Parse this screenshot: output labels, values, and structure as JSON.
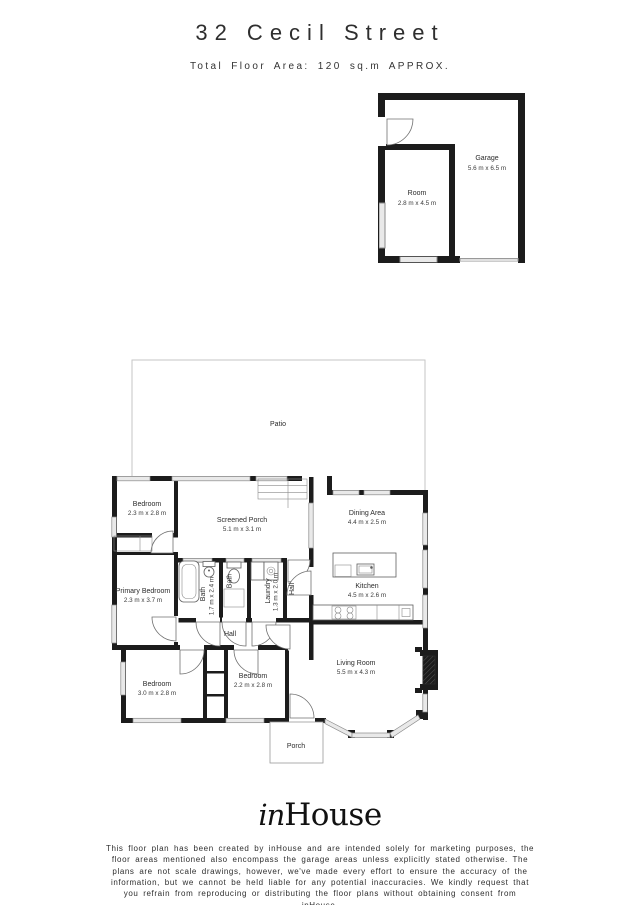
{
  "header": {
    "title": "32 Cecil Street",
    "subtitle": "Total Floor Area: 120 sq.m APPROX."
  },
  "garage_block": {
    "garage": {
      "name": "Garage",
      "dims": "5.6 m x 6.5 m"
    },
    "room": {
      "name": "Room",
      "dims": "2.8 m x 4.5 m"
    }
  },
  "outdoor": {
    "patio": "Patio",
    "porch": "Porch"
  },
  "rooms": {
    "bedroom_top": {
      "name": "Bedroom",
      "dims": "2.3 m x 2.8 m"
    },
    "screened_porch": {
      "name": "Screened Porch",
      "dims": "5.1 m x 3.1 m"
    },
    "dining": {
      "name": "Dining Area",
      "dims": "4.4 m x 2.5 m"
    },
    "kitchen": {
      "name": "Kitchen",
      "dims": "4.5 m x 2.6 m"
    },
    "primary_bedroom": {
      "name": "Primary Bedroom",
      "dims": "2.3 m x 3.7 m"
    },
    "bath_main": {
      "name": "Bath",
      "dims": "1.7 m x 2.4 m"
    },
    "bath_small": {
      "name": "Bath"
    },
    "laundry": {
      "name": "Laundry",
      "dims": "1.3 m x 2.0 m"
    },
    "hall_upper": {
      "name": "Hall"
    },
    "hall_lower": {
      "name": "Hall"
    },
    "bedroom_left": {
      "name": "Bedroom",
      "dims": "3.0 m x 2.8 m"
    },
    "bedroom_mid": {
      "name": "Bedroom",
      "dims": "2.2 m x 2.8 m"
    },
    "living": {
      "name": "Living Room",
      "dims": "5.5 m x 4.3 m"
    }
  },
  "footer": {
    "logo_in": "in",
    "logo_house": "House",
    "disclaimer": "This floor plan has been created by inHouse and are intended solely for marketing purposes, the floor areas mentioned also encompass the garage areas unless explicitly stated otherwise. The plans are not scale drawings, however, we've made every effort to ensure the accuracy of the information, but we cannot be held liable for any potential inaccuracies. We kindly request that you refrain from reproducing or distributing the floor plans without obtaining consent from inHouse."
  },
  "colors": {
    "wall": "#1c1c1c",
    "window_fill": "#e9e9e9",
    "window_stroke": "#8a8a8a",
    "patio_stroke": "#c6c6c6",
    "text": "#2b2b2b"
  }
}
